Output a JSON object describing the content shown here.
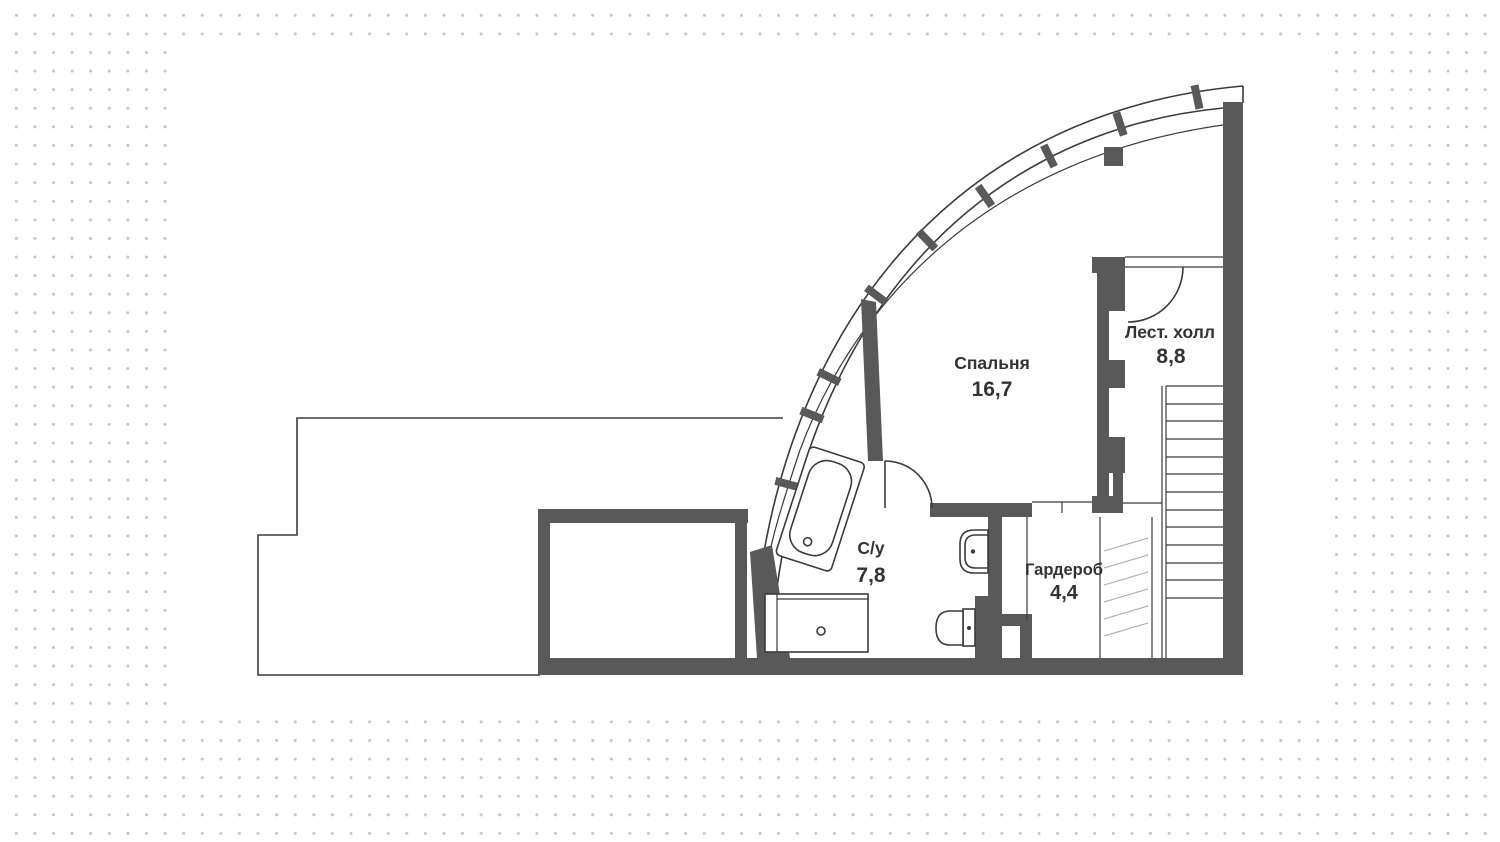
{
  "plan": {
    "rooms": [
      {
        "name": "Спальня",
        "area": "16,7"
      },
      {
        "name": "Лест. холл",
        "area": "8,8"
      },
      {
        "name": "С/у",
        "area": "7,8"
      },
      {
        "name": "Гардероб",
        "area": "4,4"
      }
    ]
  },
  "colors": {
    "wall": "#595959",
    "line": "#3b3b3b",
    "hatch": "#a9a9a9",
    "dot": "#c6c6c6",
    "paper": "#ffffff",
    "text": "#333333"
  }
}
